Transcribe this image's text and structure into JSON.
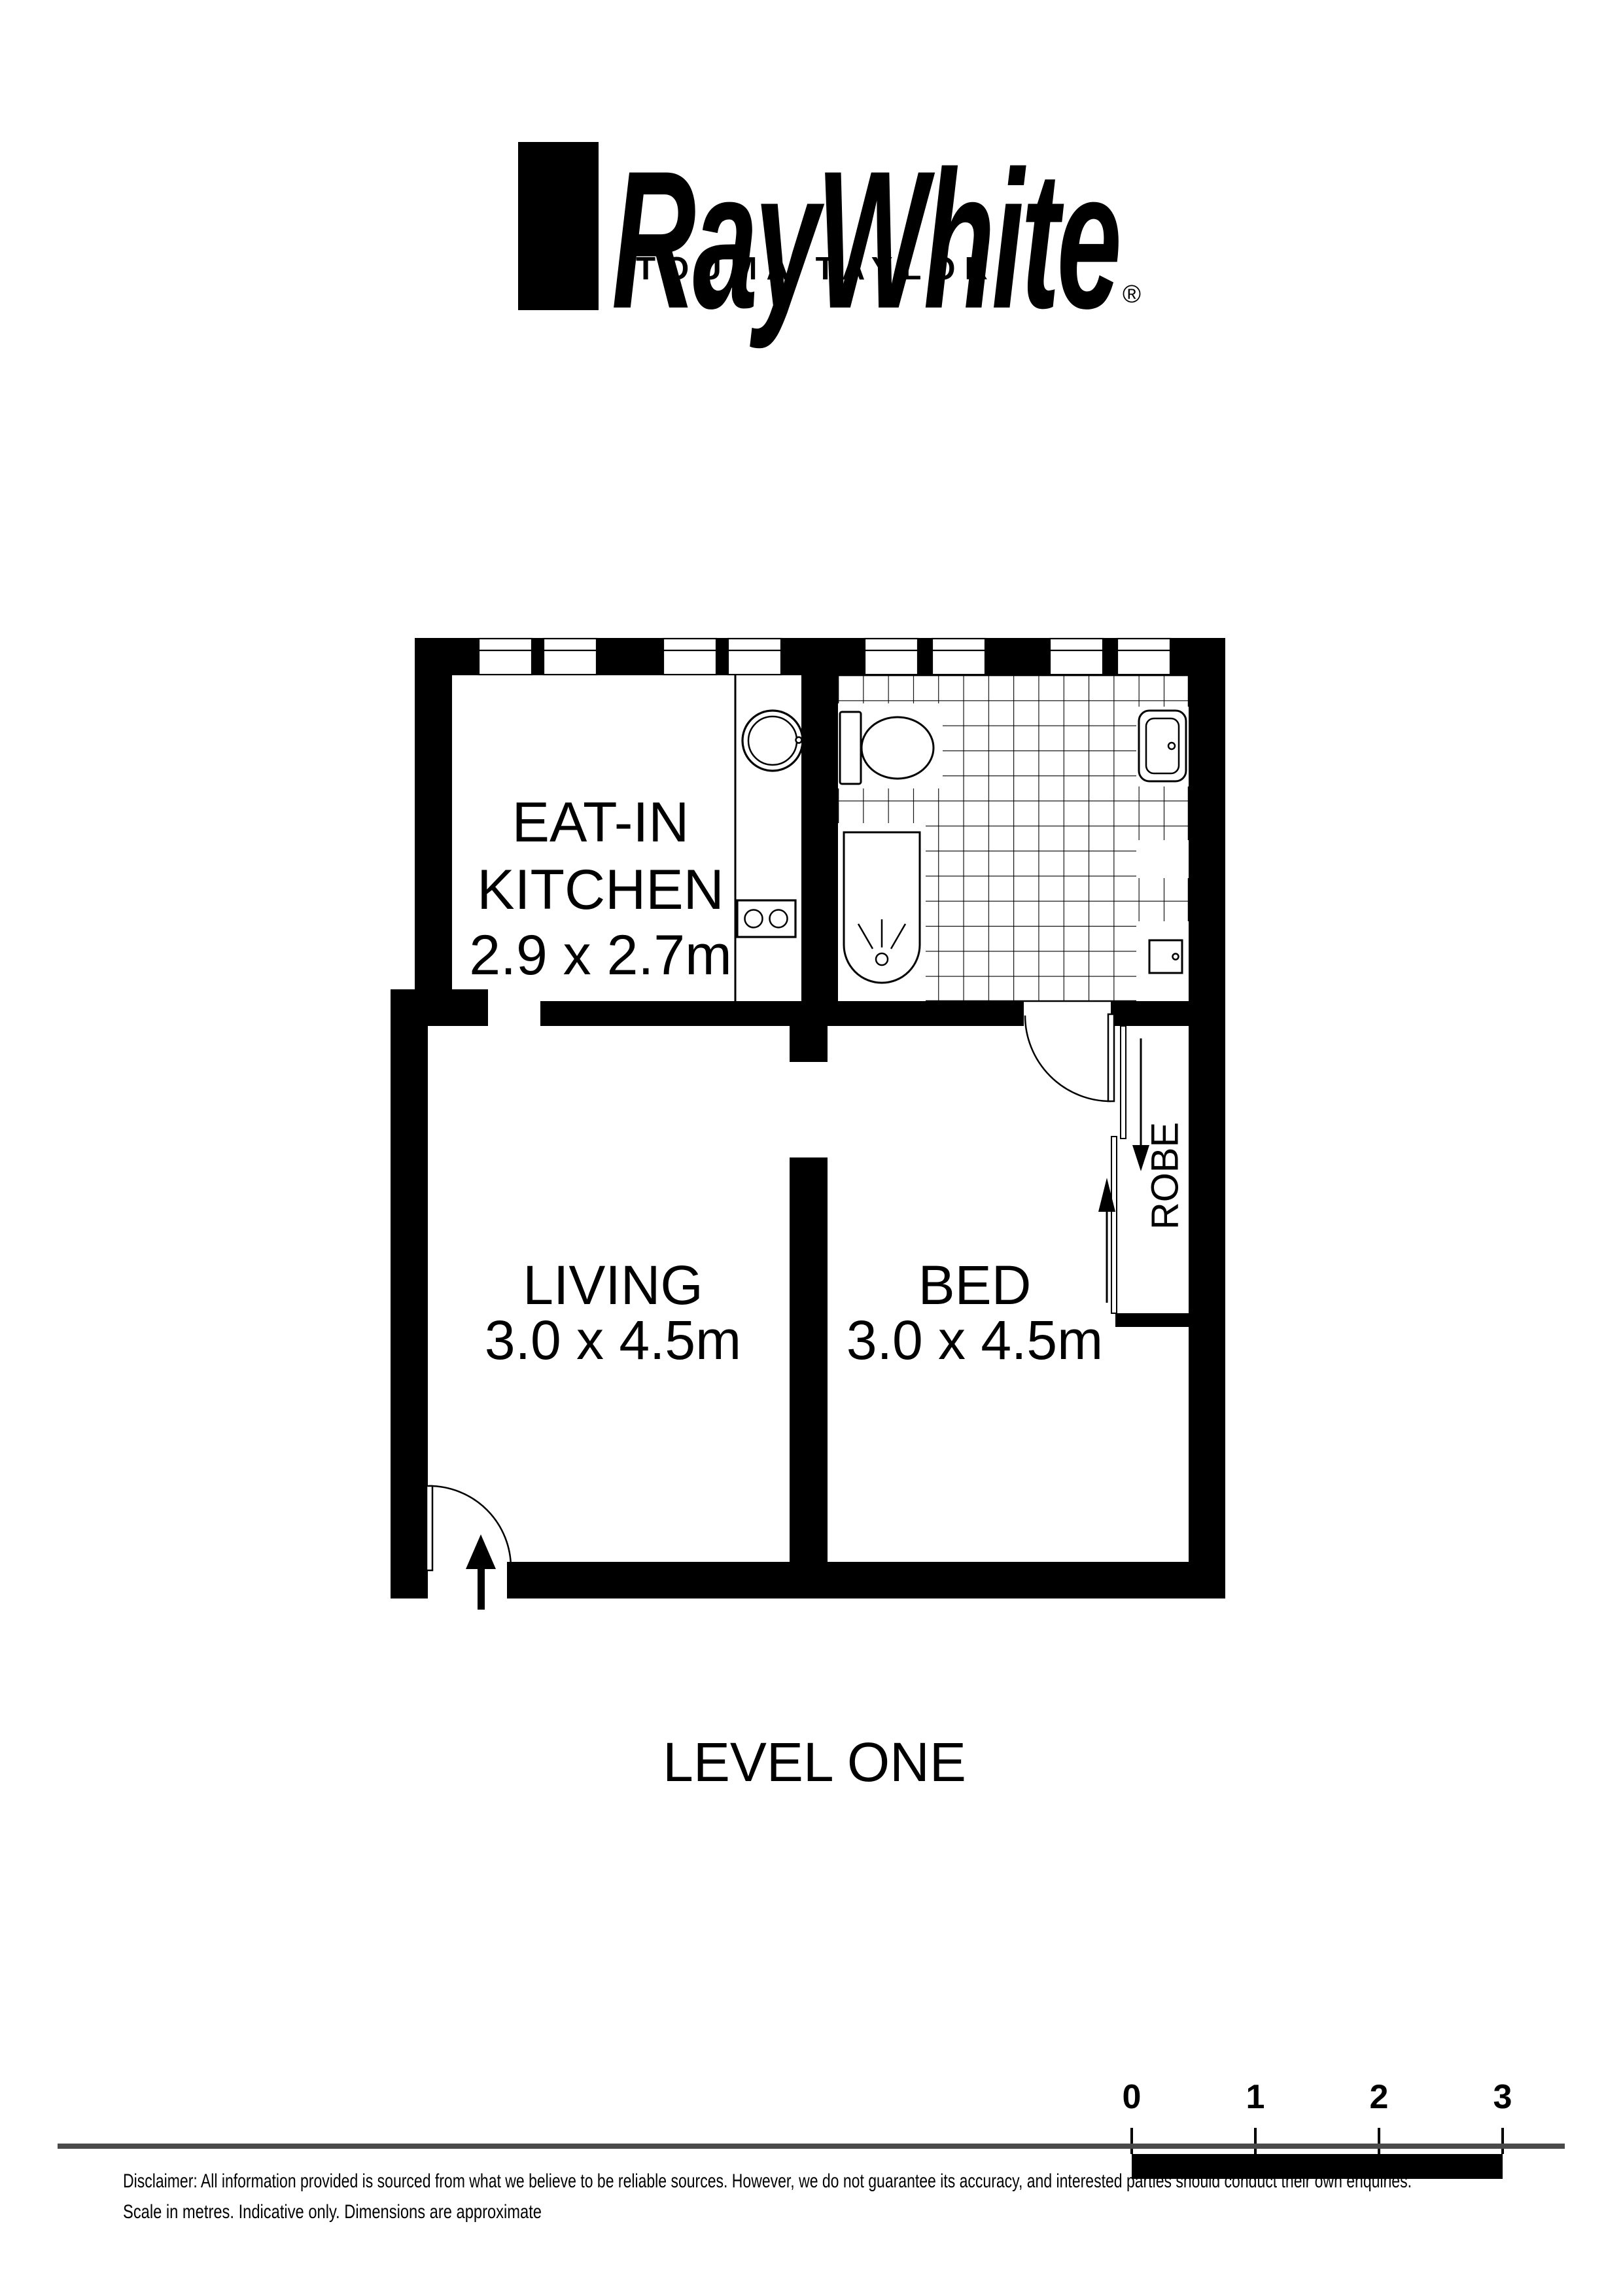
{
  "brand": {
    "logo_text": "RayWhite",
    "registered_mark": "®",
    "office_name": "TOUMA TAYLOR"
  },
  "floor_plan": {
    "level_label": "LEVEL ONE",
    "rooms": {
      "kitchen": {
        "label_line1": "EAT-IN",
        "label_line2": "KITCHEN",
        "dimensions": "2.9 x 2.7m"
      },
      "living": {
        "label": "LIVING",
        "dimensions": "3.0 x 4.5m"
      },
      "bed": {
        "label": "BED",
        "dimensions": "3.0 x 4.5m"
      }
    },
    "wardrobe_label": "ROBE",
    "fixtures": [
      "kitchen-sink",
      "cooktop",
      "kitchen-counter",
      "toilet",
      "bathtub",
      "shower-head",
      "bathroom-basin",
      "vanity-cabinet",
      "entry-door",
      "bathroom-door",
      "robe-sliding-doors",
      "entry-arrow"
    ]
  },
  "scale_bar": {
    "tick_labels": [
      "0",
      "1",
      "2",
      "3"
    ]
  },
  "footer": {
    "disclaimer_line1": "Disclaimer: All information provided is sourced from what we believe to be reliable sources. However, we do not guarantee  its accuracy, and interested parties should conduct their own enquiries.",
    "disclaimer_line2": "Scale in metres. Indicative only. Dimensions are approximate"
  },
  "colors": {
    "ink": "#000000",
    "paper": "#ffffff",
    "rule": "#4a4a4a"
  }
}
